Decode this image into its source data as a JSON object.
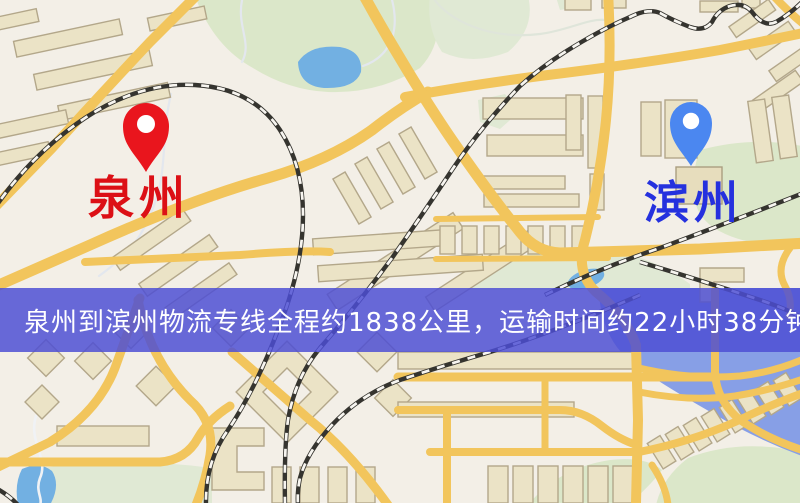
{
  "map": {
    "markers": {
      "origin": {
        "label": "泉州",
        "pin_color": "#e9151d",
        "label_color": "#dc1016"
      },
      "destination": {
        "label": "滨州",
        "pin_color": "#4b87f0",
        "label_color": "#2531de"
      }
    },
    "banner": {
      "text": "泉州到滨州物流专线全程约1838公里，运输时间约22小时38分钟.",
      "background": "#4c4ed4",
      "text_color": "#ffffff",
      "route": {
        "origin": "泉州",
        "destination": "滨州",
        "service": "物流专线",
        "distance": "约1838公里",
        "duration": "约22小时38分钟"
      }
    }
  }
}
